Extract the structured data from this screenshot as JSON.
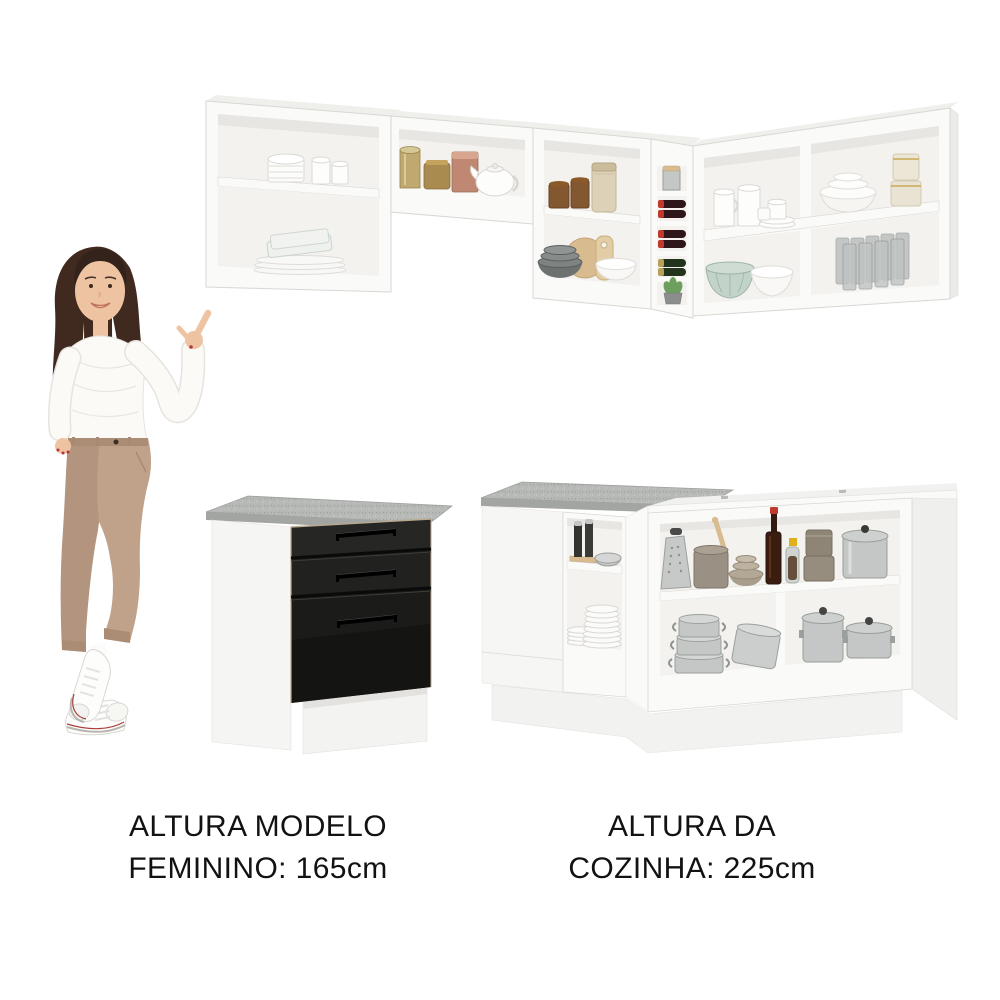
{
  "image_type": "furniture-product-photo",
  "captions": {
    "model_height": {
      "line1": "ALTURA MODELO",
      "line2": "FEMININO: 165cm"
    },
    "kitchen_height": {
      "line1": "ALTURA DA",
      "line2": "COZINHA: 225cm"
    }
  },
  "measurements": {
    "model_height_cm": "165cm",
    "kitchen_height_cm": "225cm"
  },
  "colors": {
    "background": "#ffffff",
    "text": "#121212",
    "cabinet_white": "#fafaf8",
    "cabinet_side": "#efefec",
    "cabinet_interior": "#f3f2ef",
    "cabinet_shadow": "#e4e2de",
    "cabinet_edge": "#d9d7d3",
    "countertop_gray": "#b6b9b5",
    "countertop_edge": "#a2a5a1",
    "drawer_black": "#1b1b19",
    "drawer_seam": "#b9a98e",
    "steel": "#c4c7c5",
    "steel_dark": "#999d9a",
    "amber_glass": "#7a4a20",
    "cream_jar": "#ddd2b8",
    "wood_light": "#d8bc8f",
    "brass_gold": "#bfa96f",
    "copper_rose": "#c08873",
    "bronze_tin": "#a98a4f",
    "taupe": "#9a9083",
    "sage_green": "#c2d4ca",
    "wine_dark": "#2f161b",
    "wine_cap_red": "#c03a2b",
    "bottle_green": "#22351c",
    "plant_green": "#6da05f",
    "skin": "#eec3a2",
    "hair_brown": "#40291f",
    "sweater_white": "#fbfaf7",
    "sweater_shade": "#e7e3de",
    "pants_tan": "#c0a18a",
    "pants_shade": "#ab8d76",
    "shoe_white": "#fdfdfc",
    "shoe_stripe_red": "#a8403a"
  }
}
